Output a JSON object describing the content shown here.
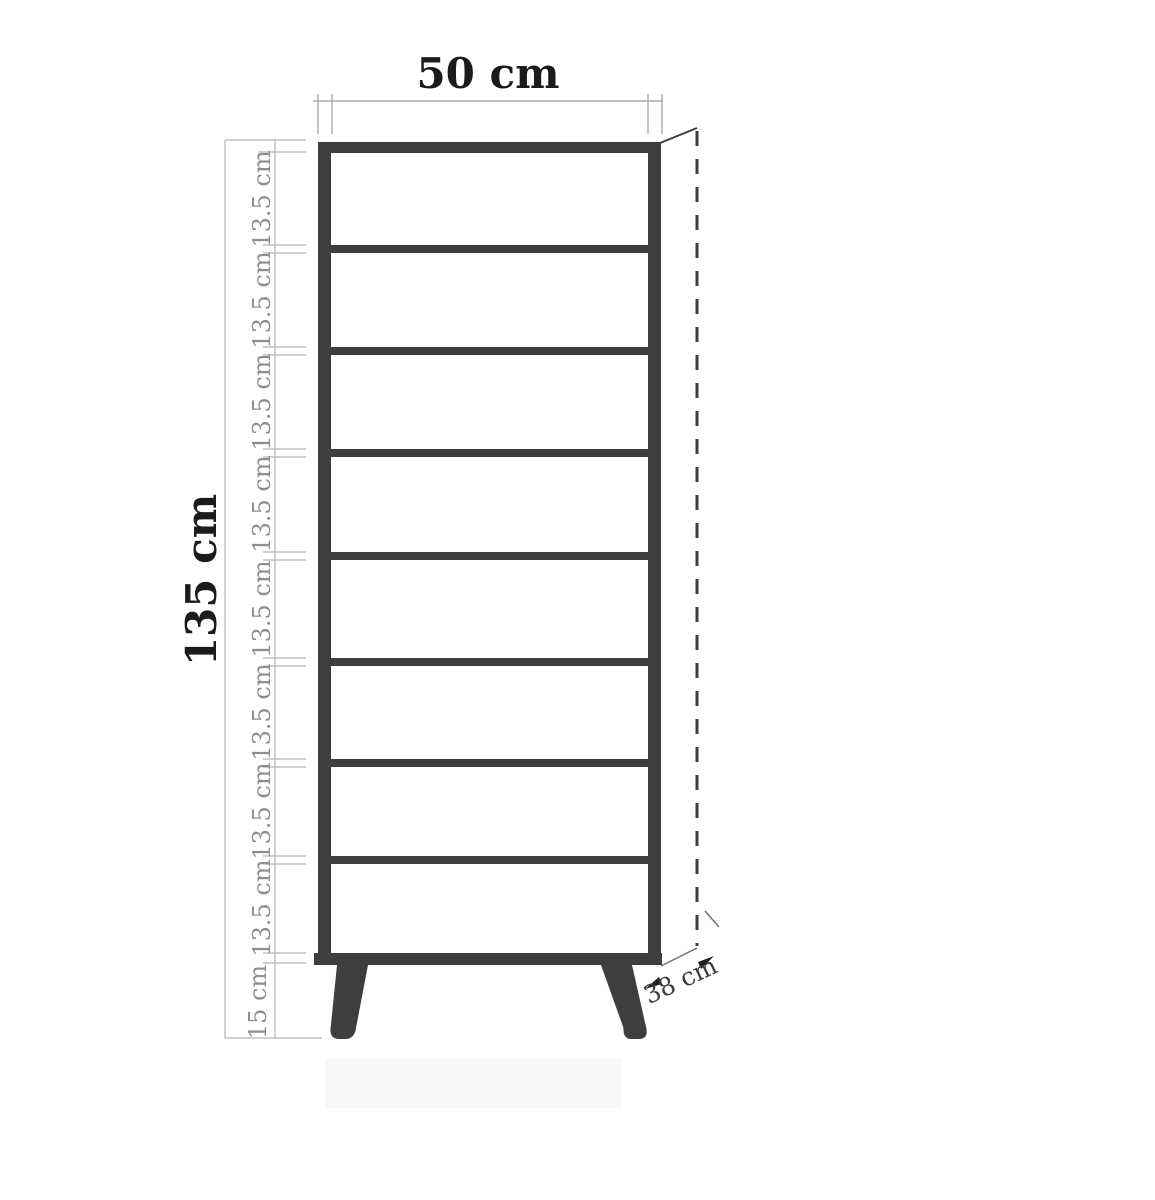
{
  "drawing": {
    "subject": "tall-shelving-cabinet-dimension-diagram",
    "dimensions": {
      "width_label": "50 cm",
      "height_label": "135 cm",
      "depth_label": "38 cm",
      "leg_height_label": "15 cm",
      "segment_labels": [
        "13.5 cm",
        "13.5 cm",
        "13.5 cm",
        "13.5 cm",
        "13.5 cm",
        "13.5 cm",
        "13.5 cm",
        "13.5 cm"
      ]
    },
    "colors": {
      "cabinet": "#3e3e40",
      "dimension_line": "#aaaaaa",
      "segment_text": "#8e8e8e",
      "primary_text": "#1b1b1b",
      "depth_text": "#3b3b3b",
      "floor_shadow": "#f8f8f8",
      "background": "#ffffff"
    }
  }
}
